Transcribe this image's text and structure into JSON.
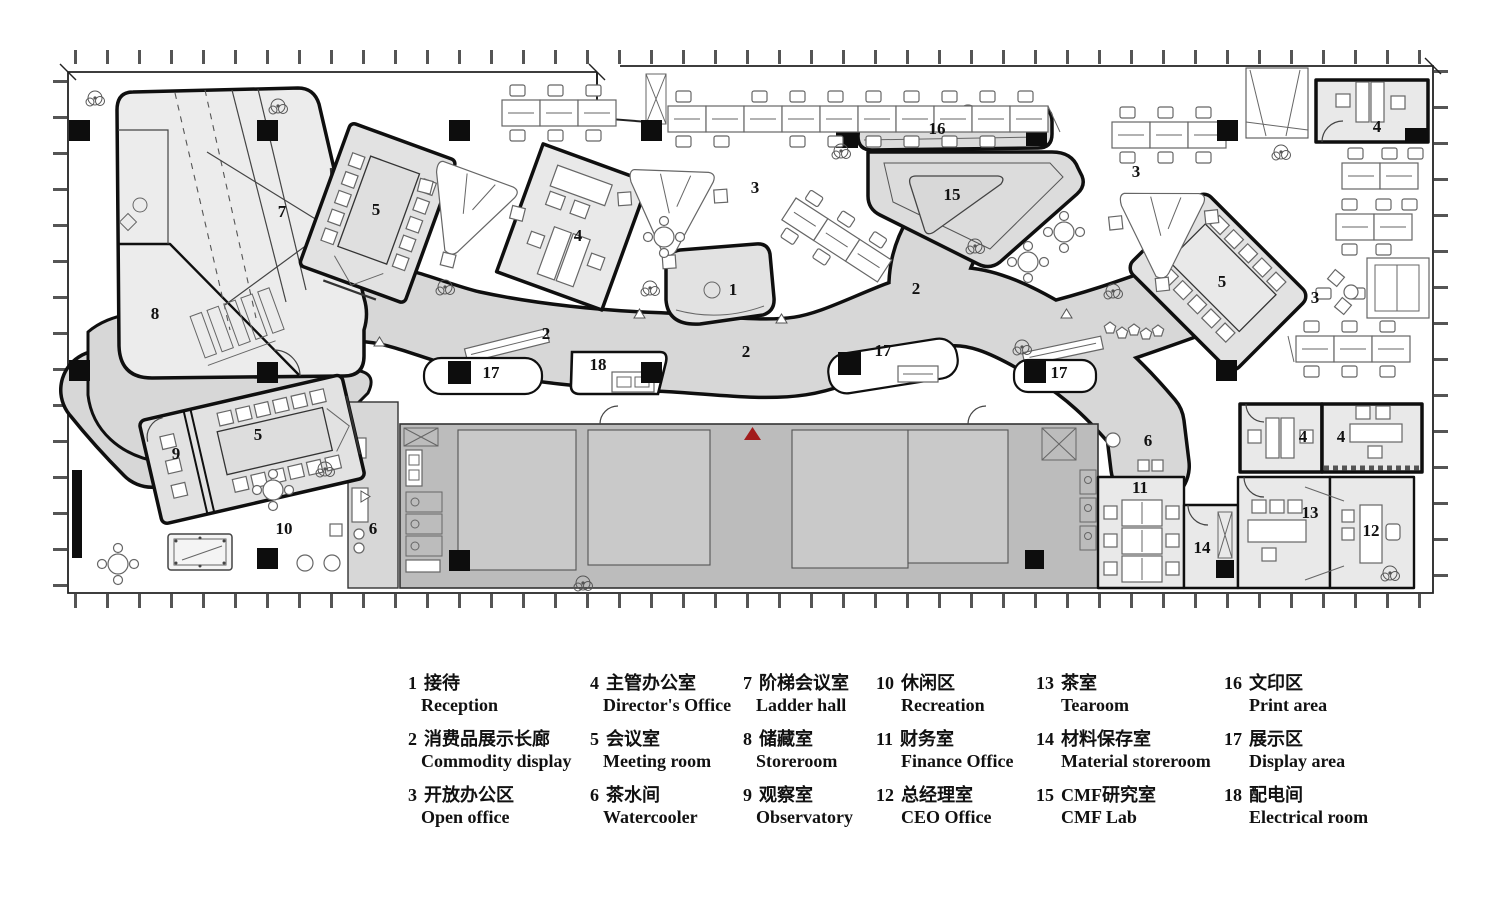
{
  "plan": {
    "marker": {
      "name": "entrance-marker",
      "color": "#a21c1c"
    },
    "colors": {
      "wall": "#0f0f0f",
      "corridor": "#d7d7d7",
      "core": "#bcbcbc",
      "core_room": "#c9c9c9",
      "room": "#e9e9e9",
      "facade": "#3a3a3a",
      "red": "#a21c1c"
    },
    "labels": [
      {
        "t": "1",
        "x": 733,
        "y": 295
      },
      {
        "t": "2",
        "x": 546,
        "y": 339
      },
      {
        "t": "2",
        "x": 746,
        "y": 357
      },
      {
        "t": "2",
        "x": 916,
        "y": 294
      },
      {
        "t": "3",
        "x": 755,
        "y": 193
      },
      {
        "t": "3",
        "x": 1136,
        "y": 177
      },
      {
        "t": "3",
        "x": 1315,
        "y": 303
      },
      {
        "t": "4",
        "x": 578,
        "y": 241
      },
      {
        "t": "4",
        "x": 1377,
        "y": 132
      },
      {
        "t": "4",
        "x": 1303,
        "y": 442
      },
      {
        "t": "4",
        "x": 1341,
        "y": 442
      },
      {
        "t": "5",
        "x": 376,
        "y": 215
      },
      {
        "t": "5",
        "x": 258,
        "y": 440
      },
      {
        "t": "5",
        "x": 1222,
        "y": 287
      },
      {
        "t": "6",
        "x": 373,
        "y": 534
      },
      {
        "t": "6",
        "x": 1148,
        "y": 446
      },
      {
        "t": "7",
        "x": 282,
        "y": 217
      },
      {
        "t": "8",
        "x": 155,
        "y": 319
      },
      {
        "t": "9",
        "x": 176,
        "y": 459
      },
      {
        "t": "10",
        "x": 284,
        "y": 534
      },
      {
        "t": "11",
        "x": 1140,
        "y": 493
      },
      {
        "t": "12",
        "x": 1371,
        "y": 536
      },
      {
        "t": "13",
        "x": 1310,
        "y": 518
      },
      {
        "t": "14",
        "x": 1202,
        "y": 553
      },
      {
        "t": "15",
        "x": 952,
        "y": 200
      },
      {
        "t": "16",
        "x": 937,
        "y": 134
      },
      {
        "t": "17",
        "x": 491,
        "y": 378
      },
      {
        "t": "17",
        "x": 883,
        "y": 356
      },
      {
        "t": "17",
        "x": 1059,
        "y": 378
      },
      {
        "t": "18",
        "x": 598,
        "y": 370
      }
    ]
  },
  "legend": {
    "items": [
      {
        "num": "1",
        "zh": "接待",
        "en": "Reception"
      },
      {
        "num": "2",
        "zh": "消费品展示长廊",
        "en": "Commodity display"
      },
      {
        "num": "3",
        "zh": "开放办公区",
        "en": "Open office"
      },
      {
        "num": "4",
        "zh": "主管办公室",
        "en": "Director's Office"
      },
      {
        "num": "5",
        "zh": "会议室",
        "en": "Meeting room"
      },
      {
        "num": "6",
        "zh": "茶水间",
        "en": "Watercooler"
      },
      {
        "num": "7",
        "zh": "阶梯会议室",
        "en": "Ladder hall"
      },
      {
        "num": "8",
        "zh": "储藏室",
        "en": "Storeroom"
      },
      {
        "num": "9",
        "zh": "观察室",
        "en": "Observatory"
      },
      {
        "num": "10",
        "zh": "休闲区",
        "en": "Recreation"
      },
      {
        "num": "11",
        "zh": "财务室",
        "en": "Finance Office"
      },
      {
        "num": "12",
        "zh": "总经理室",
        "en": "CEO Office"
      },
      {
        "num": "13",
        "zh": "茶室",
        "en": "Tearoom"
      },
      {
        "num": "14",
        "zh": "材料保存室",
        "en": "Material storeroom"
      },
      {
        "num": "15",
        "zh": "CMF研究室",
        "en": "CMF Lab"
      },
      {
        "num": "16",
        "zh": "文印区",
        "en": "Print area"
      },
      {
        "num": "17",
        "zh": "展示区",
        "en": "Display area"
      },
      {
        "num": "18",
        "zh": "配电间",
        "en": "Electrical room"
      }
    ]
  }
}
